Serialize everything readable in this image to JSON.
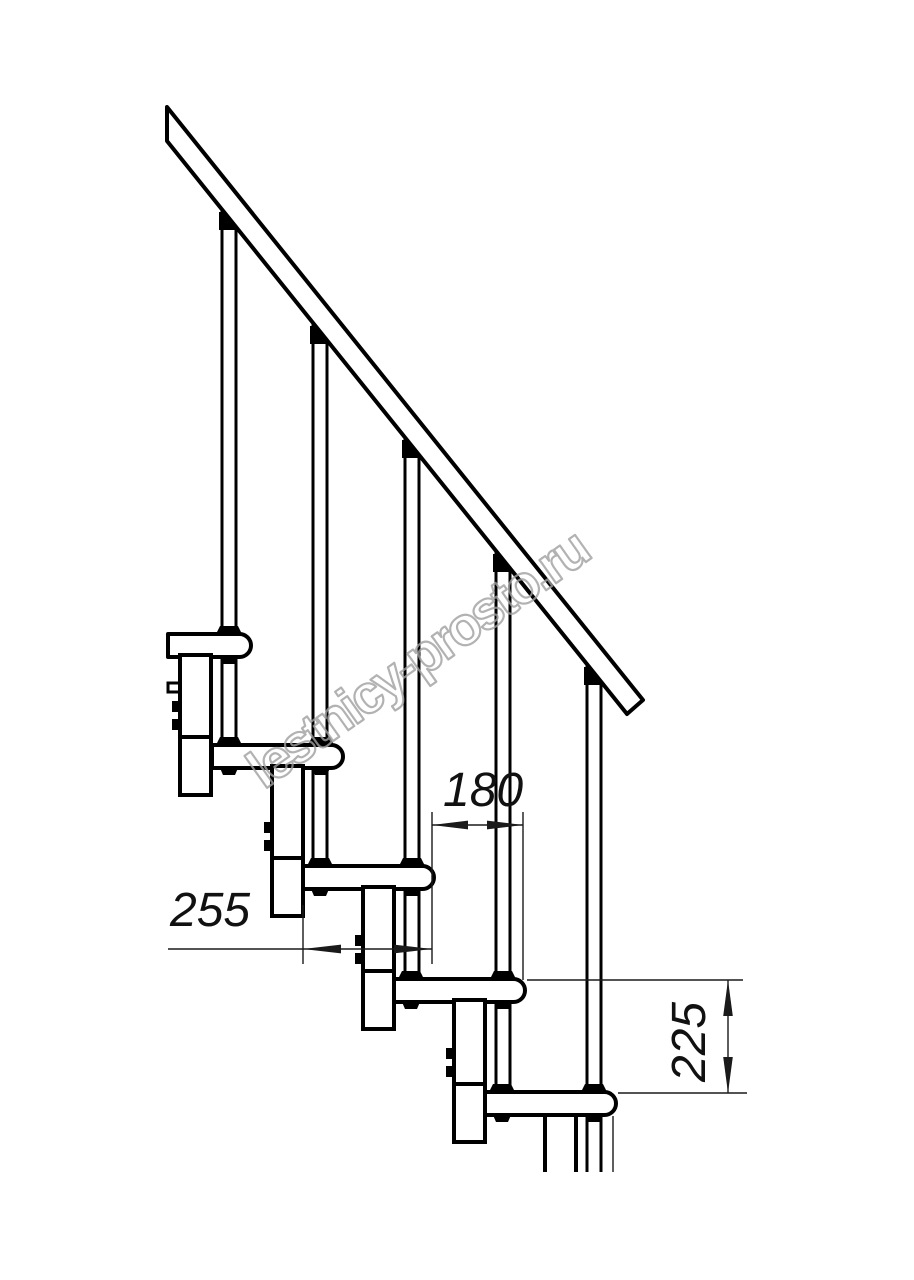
{
  "drawing": {
    "dimensions": {
      "run_label": "180",
      "depth_label": "255",
      "rise_label": "225"
    },
    "watermark_text": "lestnicy-prosto.ru",
    "colors": {
      "line": "#000000",
      "dimension": "#1a1a1a",
      "watermark": "#a0a0a0",
      "background": "#ffffff"
    }
  }
}
